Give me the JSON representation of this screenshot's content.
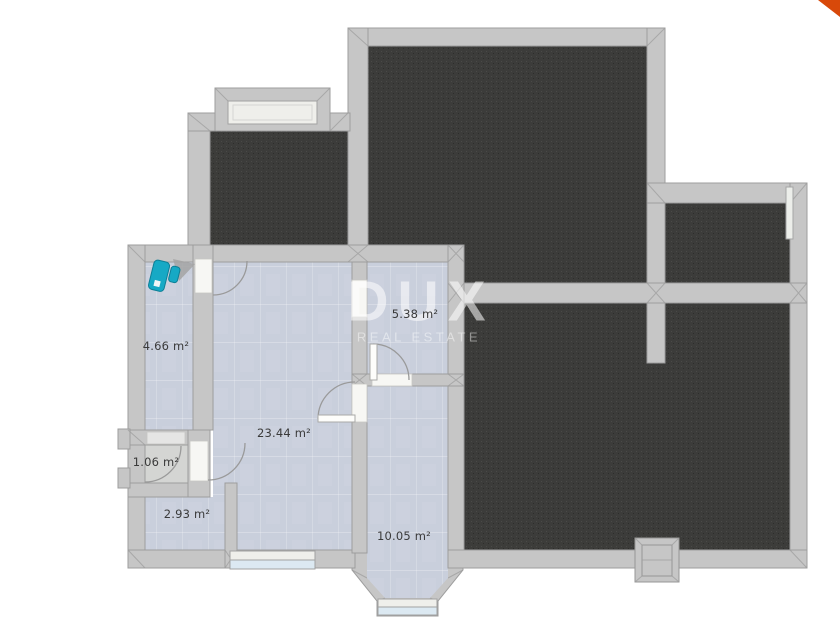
{
  "watermark": {
    "brand": "DUX",
    "tagline": "REAL ESTATE"
  },
  "rooms": [
    {
      "area_label": "4.66 m²"
    },
    {
      "area_label": "23.44 m²"
    },
    {
      "area_label": "5.38 m²"
    },
    {
      "area_label": "1.06 m²"
    },
    {
      "area_label": "2.93 m²"
    },
    {
      "area_label": "10.05 m²"
    }
  ],
  "fixtures": [
    {
      "icon": "toilet-icon",
      "color": "#16a9c5"
    }
  ],
  "colors": {
    "wall": "#c6c6c6",
    "wall_line": "#9d9d9d",
    "floor_dark": "#3c3c3a",
    "floor_light": "#c9cfdc",
    "floor_gray": "#d4d5d3",
    "sill": "#efefeb",
    "glass": "#dce9f2",
    "thresh": "#f7f7f4",
    "teal": "#16a9c5",
    "teal_dark": "#0d7f96",
    "ribbon": "#d8490a",
    "label_text": "#3a3a3a",
    "watermark": "rgba(255,255,255,0.55)",
    "watermark_soft": "rgba(255,255,255,0.45)"
  }
}
